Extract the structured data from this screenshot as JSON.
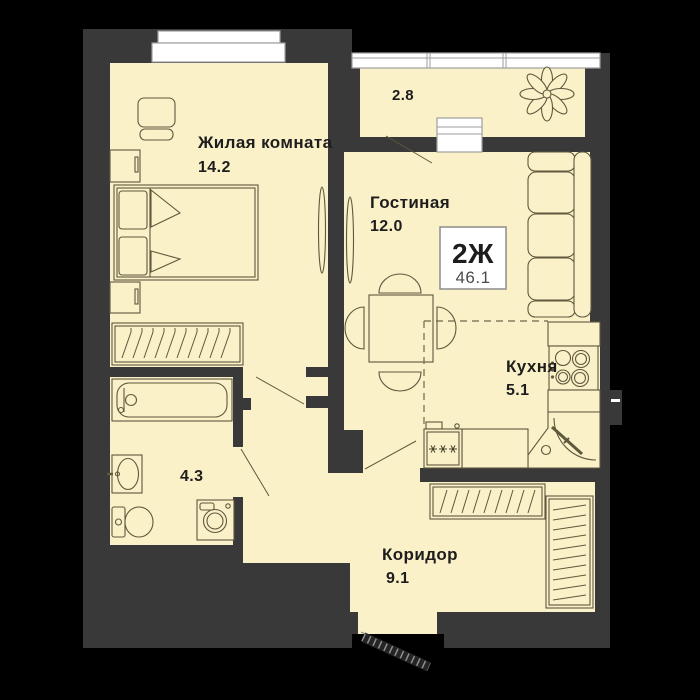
{
  "plan": {
    "badge": {
      "type": "2Ж",
      "total_area": "46.1"
    },
    "rooms": {
      "bedroom": {
        "label": "Жилая комната",
        "area": "14.2"
      },
      "living": {
        "label": "Гостиная",
        "area": "12.0"
      },
      "kitchen": {
        "label": "Кухня",
        "area": "5.1"
      },
      "corridor": {
        "label": "Коридор",
        "area": "9.1"
      },
      "bathroom": {
        "area": "4.3"
      },
      "balcony": {
        "area": "2.8"
      }
    },
    "icons": {
      "balcony_plant": "flower-icon",
      "fridge_marks": "✳ ✳ ✳",
      "entrance": "door-leaf-hatched-icon"
    },
    "colors": {
      "background": "#000000",
      "wall": "#393939",
      "floor": "#FAF1C8",
      "line": "#5E583D",
      "window": "#FFFFFF",
      "text": "#1D1D1D"
    }
  }
}
